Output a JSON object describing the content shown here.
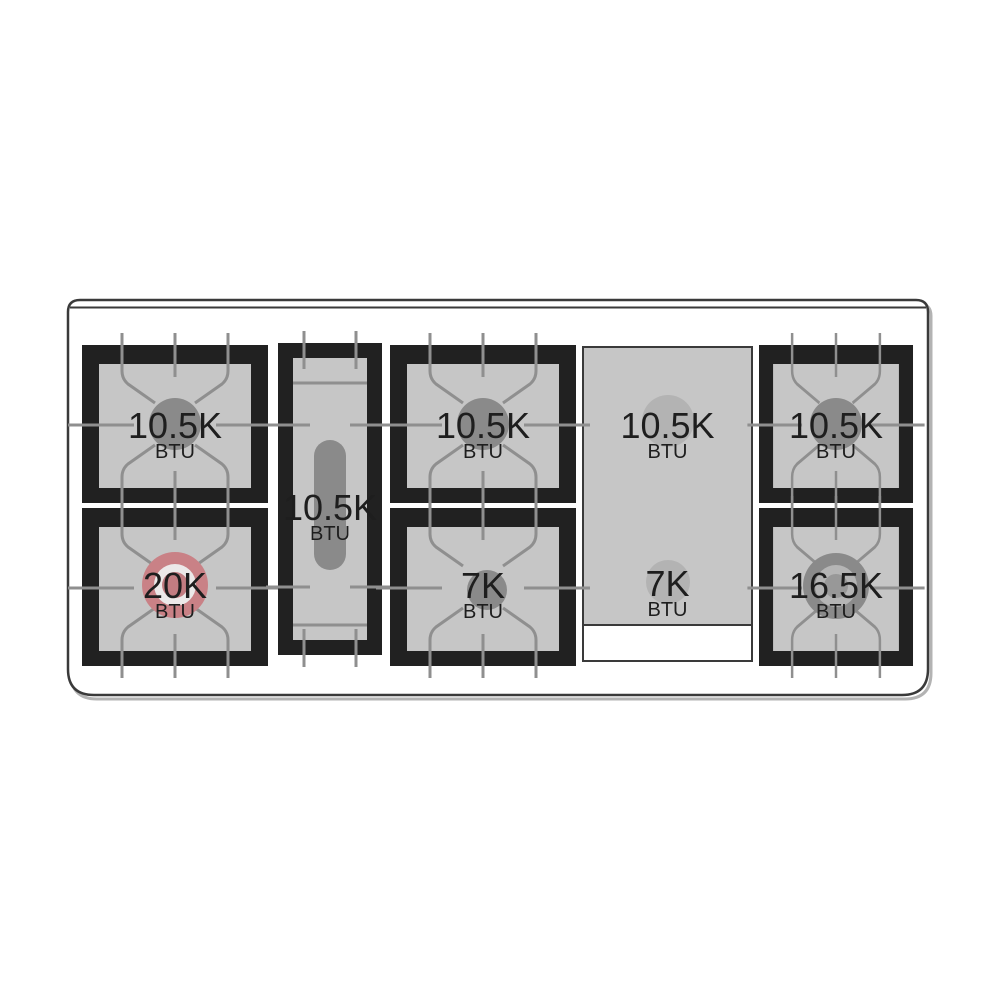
{
  "burners": [
    {
      "id": "top-left",
      "value": "10.5K",
      "unit": "BTU",
      "shape": "square",
      "highlighted": false
    },
    {
      "id": "bottom-left",
      "value": "20K",
      "unit": "BTU",
      "shape": "square",
      "highlighted": true
    },
    {
      "id": "center-oval",
      "value": "10.5K",
      "unit": "BTU",
      "shape": "oval",
      "highlighted": false
    },
    {
      "id": "top-middle",
      "value": "10.5K",
      "unit": "BTU",
      "shape": "square",
      "highlighted": false
    },
    {
      "id": "bottom-middle",
      "value": "7K",
      "unit": "BTU",
      "shape": "square",
      "highlighted": false
    },
    {
      "id": "griddle-top",
      "value": "10.5K",
      "unit": "BTU",
      "shape": "griddle",
      "highlighted": false
    },
    {
      "id": "griddle-bottom",
      "value": "7K",
      "unit": "BTU",
      "shape": "griddle",
      "highlighted": false
    },
    {
      "id": "top-right",
      "value": "10.5K",
      "unit": "BTU",
      "shape": "square",
      "highlighted": false
    },
    {
      "id": "bottom-right",
      "value": "16.5K",
      "unit": "BTU",
      "shape": "square",
      "highlighted": false
    }
  ],
  "colors": {
    "outline_stroke": "#3a3a3a",
    "outline_shadow": "#b3b3b3",
    "frame_black": "#212121",
    "surface_gray": "#c6c6c6",
    "grate_line": "#8f8f8f",
    "burner_gray": "#8a8a8a",
    "griddle_circle": "#b3b3b3",
    "ring_light": "#b5b5b5",
    "ring_white": "#ece9e9",
    "burner_center_gray": "#989898",
    "highlight_red": "#c98186",
    "highlight_red_center": "#c27c81",
    "text_black": "#1e1e1e"
  }
}
